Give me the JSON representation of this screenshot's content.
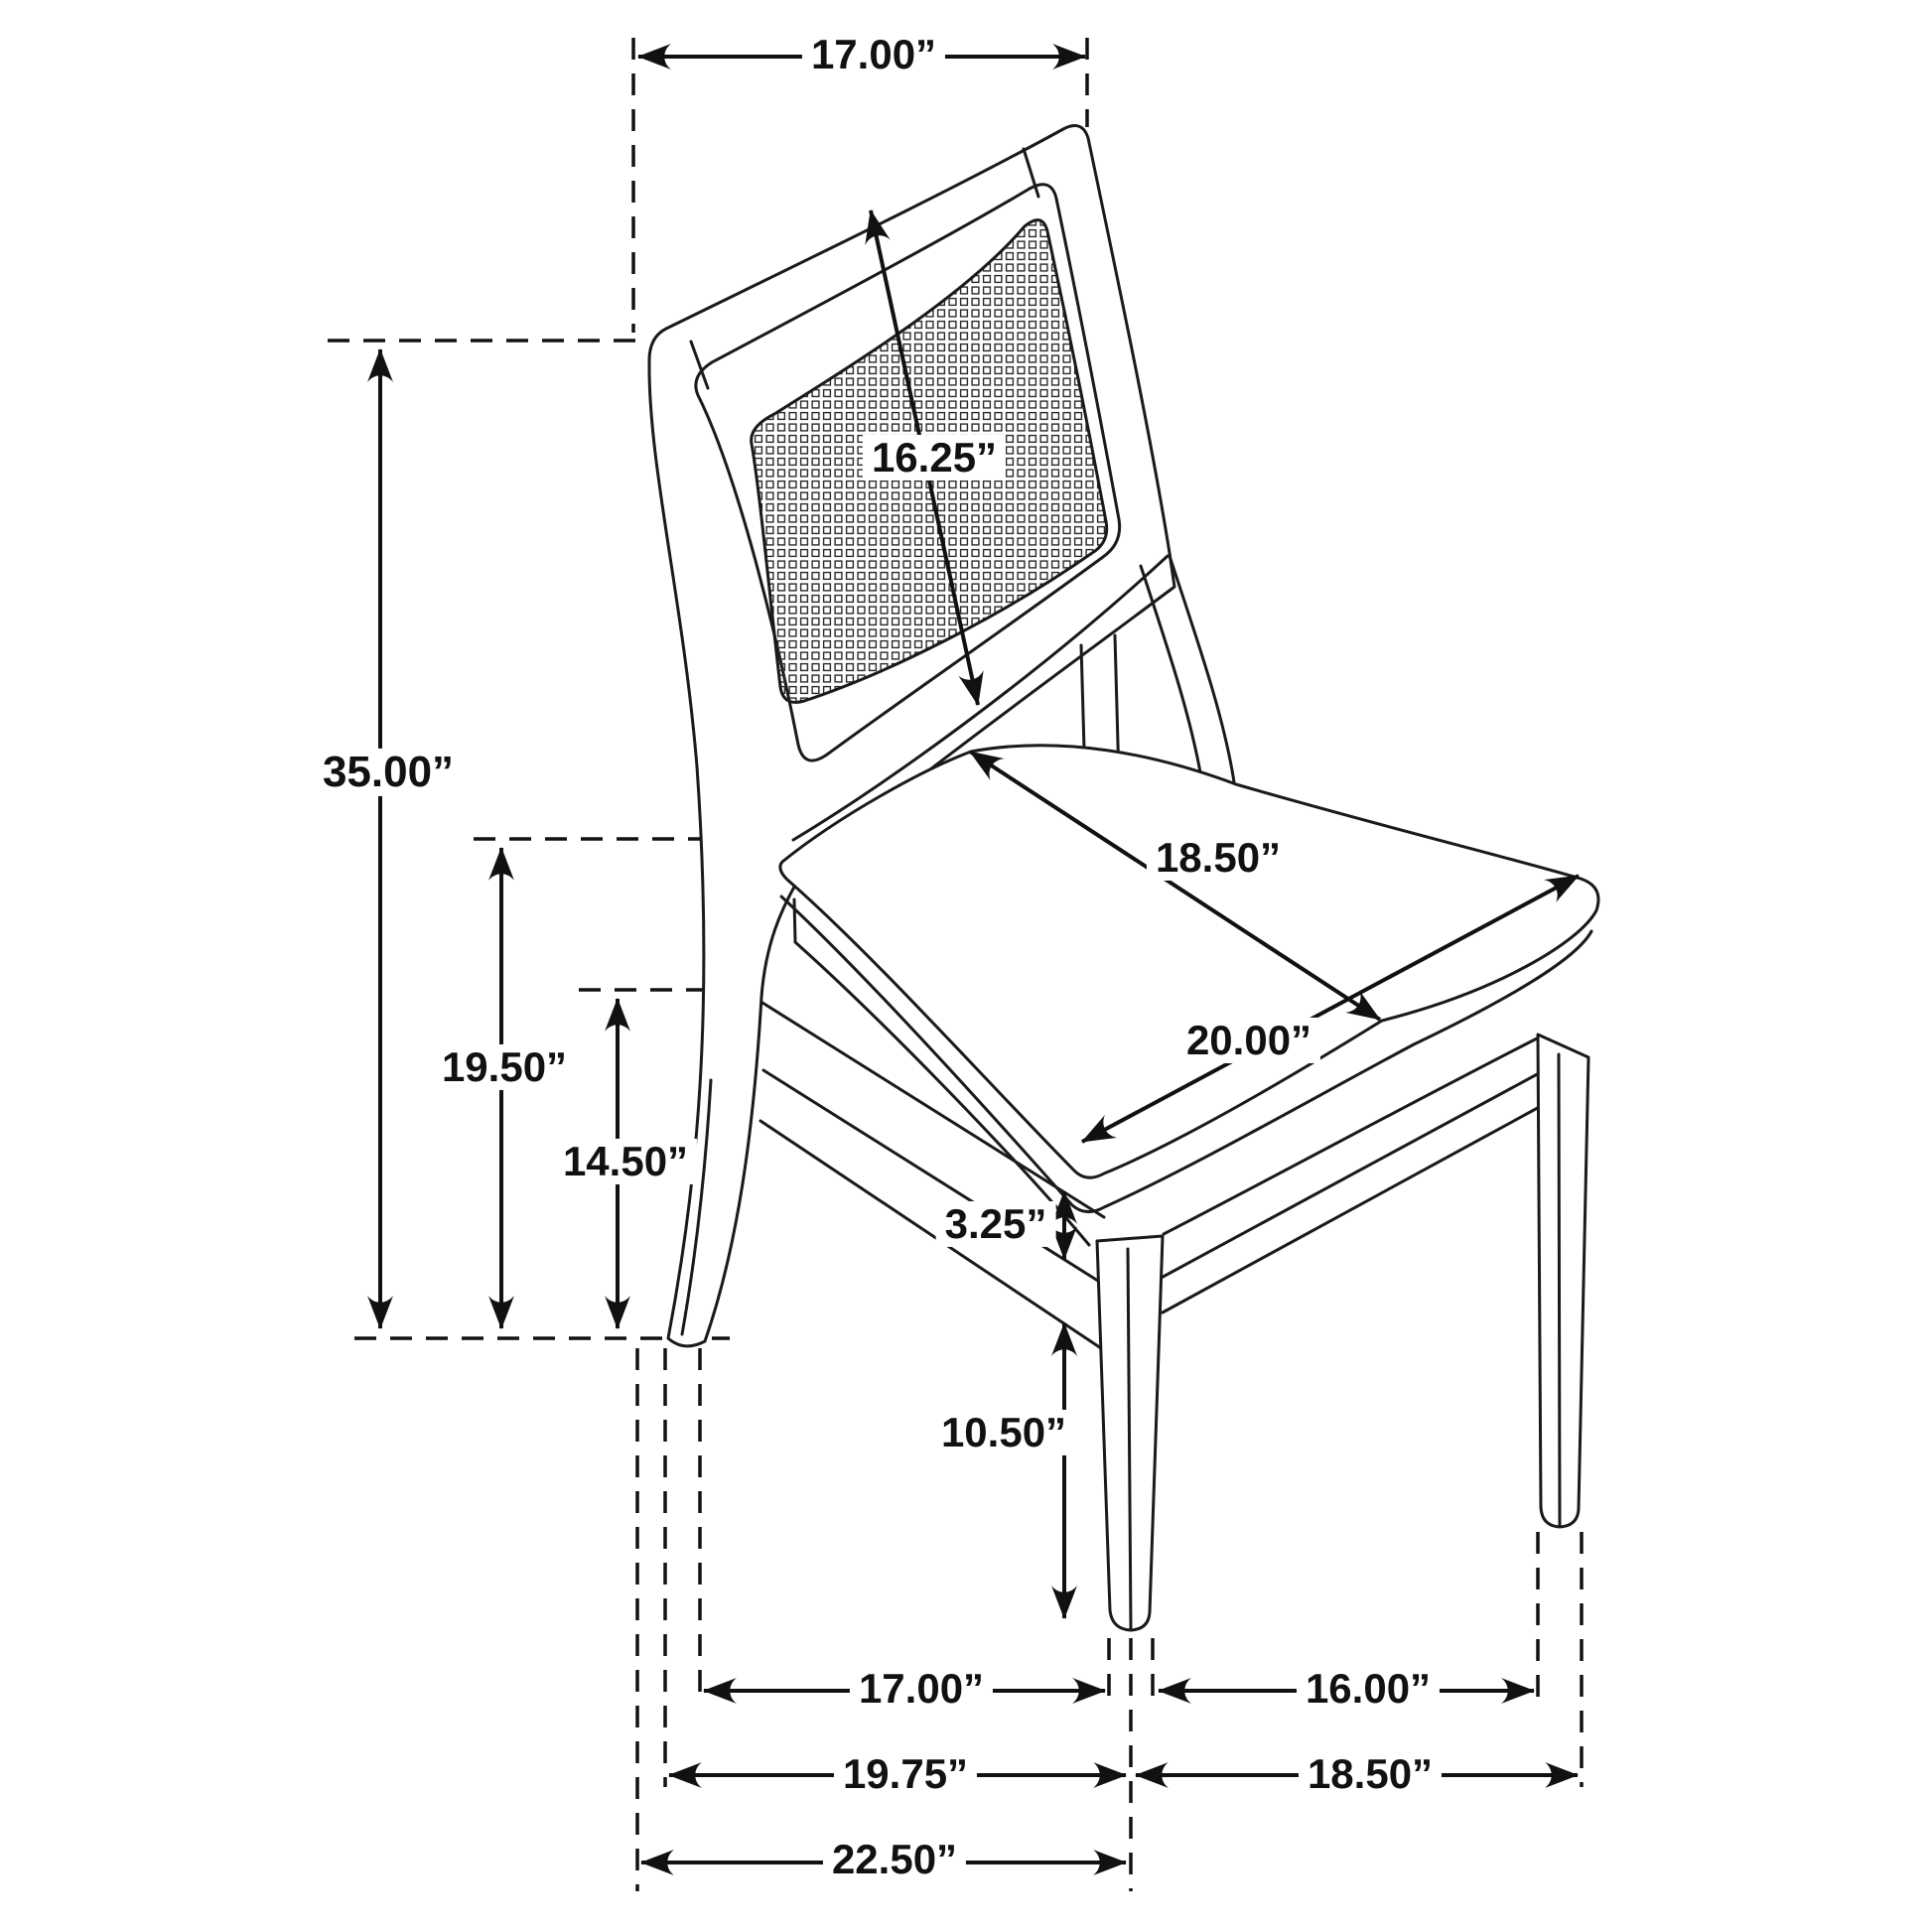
{
  "diagram_type": "furniture-dimension-diagram",
  "subject": "dining side chair with cane back and upholstered seat",
  "colors": {
    "ink": "#1a1a1a",
    "background": "#ffffff"
  },
  "dim": {
    "back_top_width": "17.00”",
    "back_height": "16.25”",
    "overall_height": "35.00”",
    "seat_height": "19.50”",
    "stretcher_top_height": "14.50”",
    "seat_depth": "18.50”",
    "seat_width": "20.00”",
    "stretcher_thickness": "3.25”",
    "stretcher_clearance": "10.50”",
    "leg_spacing_side": "17.00”",
    "leg_spacing_front": "16.00”",
    "base_depth": "19.75”",
    "base_width": "18.50”",
    "overall_depth": "22.50”"
  }
}
